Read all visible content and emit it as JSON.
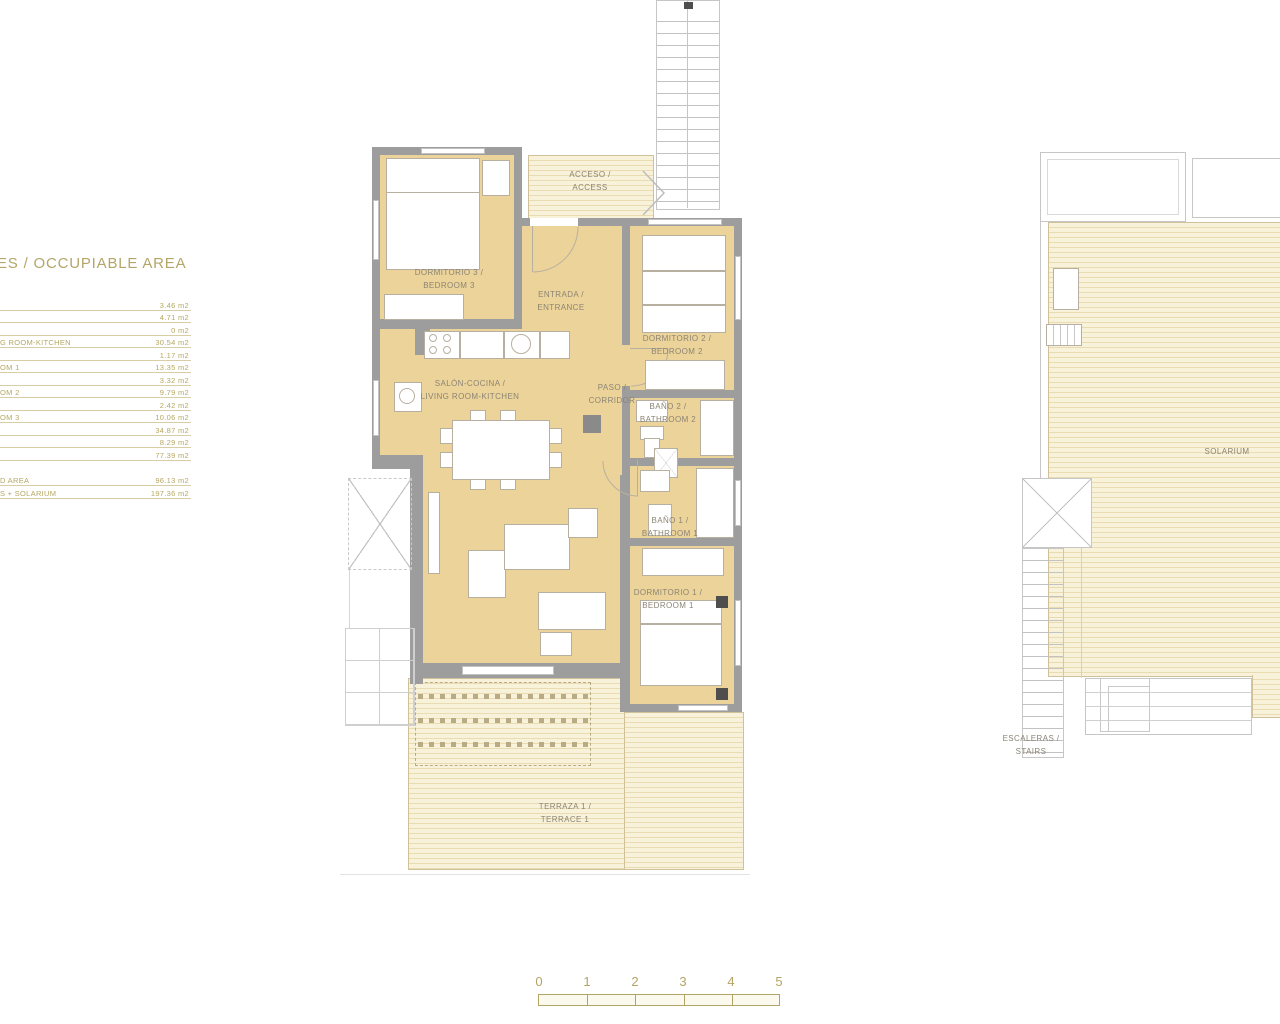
{
  "legend": {
    "title": "ES / OCCUPIABLE AREA",
    "rows": [
      {
        "label": "",
        "value": "3.46 m2"
      },
      {
        "label": "",
        "value": "4.71 m2"
      },
      {
        "label": "",
        "value": "0 m2"
      },
      {
        "label": "G ROOM-KITCHEN",
        "value": "30.54 m2"
      },
      {
        "label": "",
        "value": "1.17 m2"
      },
      {
        "label": "OM 1",
        "value": "13.35 m2"
      },
      {
        "label": "",
        "value": "3.32 m2"
      },
      {
        "label": "OM 2",
        "value": "9.79 m2"
      },
      {
        "label": "",
        "value": "2.42 m2"
      },
      {
        "label": "OM 3",
        "value": "10.06 m2"
      },
      {
        "label": "",
        "value": "34.87 m2"
      },
      {
        "label": "",
        "value": "8.29 m2"
      },
      {
        "label": "",
        "value": "77.39 m2"
      }
    ],
    "summary": [
      {
        "label": "D AREA",
        "value": "96.13 m2"
      },
      {
        "label": "S + SOLARIUM",
        "value": "197.36 m2"
      }
    ]
  },
  "floor_plan": {
    "labels": {
      "bedroom3": [
        "DORMITORIO 3 /",
        "BEDROOM 3"
      ],
      "access": [
        "ACCESO /",
        "ACCESS"
      ],
      "entrance": [
        "ENTRADA /",
        "ENTRANCE"
      ],
      "bedroom2": [
        "DORMITORIO 2 /",
        "BEDROOM 2"
      ],
      "living": [
        "SALÓN-COCINA /",
        "LIVING ROOM-KITCHEN"
      ],
      "corridor": [
        "PASO /",
        "CORRIDOR"
      ],
      "bathroom2": [
        "BAÑO 2 /",
        "BATHROOM 2"
      ],
      "bathroom1": [
        "BAÑO 1 /",
        "BATHROOM 1"
      ],
      "bedroom1": [
        "DORMITORIO 1 /",
        "BEDROOM 1"
      ],
      "terrace": [
        "TERRAZA 1 /",
        "TERRACE 1"
      ]
    }
  },
  "solarium_plan": {
    "label": "SOLARIUM",
    "stairs": [
      "ESCALERAS /",
      "STAIRS"
    ]
  },
  "scale_bar": {
    "ticks": [
      "0",
      "1",
      "2",
      "3",
      "4",
      "5"
    ]
  },
  "colors": {
    "room_fill": "#ecd39a",
    "wall": "#9d9d9d",
    "deck_light": "#f9f2db",
    "deck_stripe": "#e9dcb3",
    "plan_text": "#8b8474",
    "legend_text": "#b5a863",
    "scale_text": "#b2a466",
    "outline": "#c6c6c6"
  }
}
